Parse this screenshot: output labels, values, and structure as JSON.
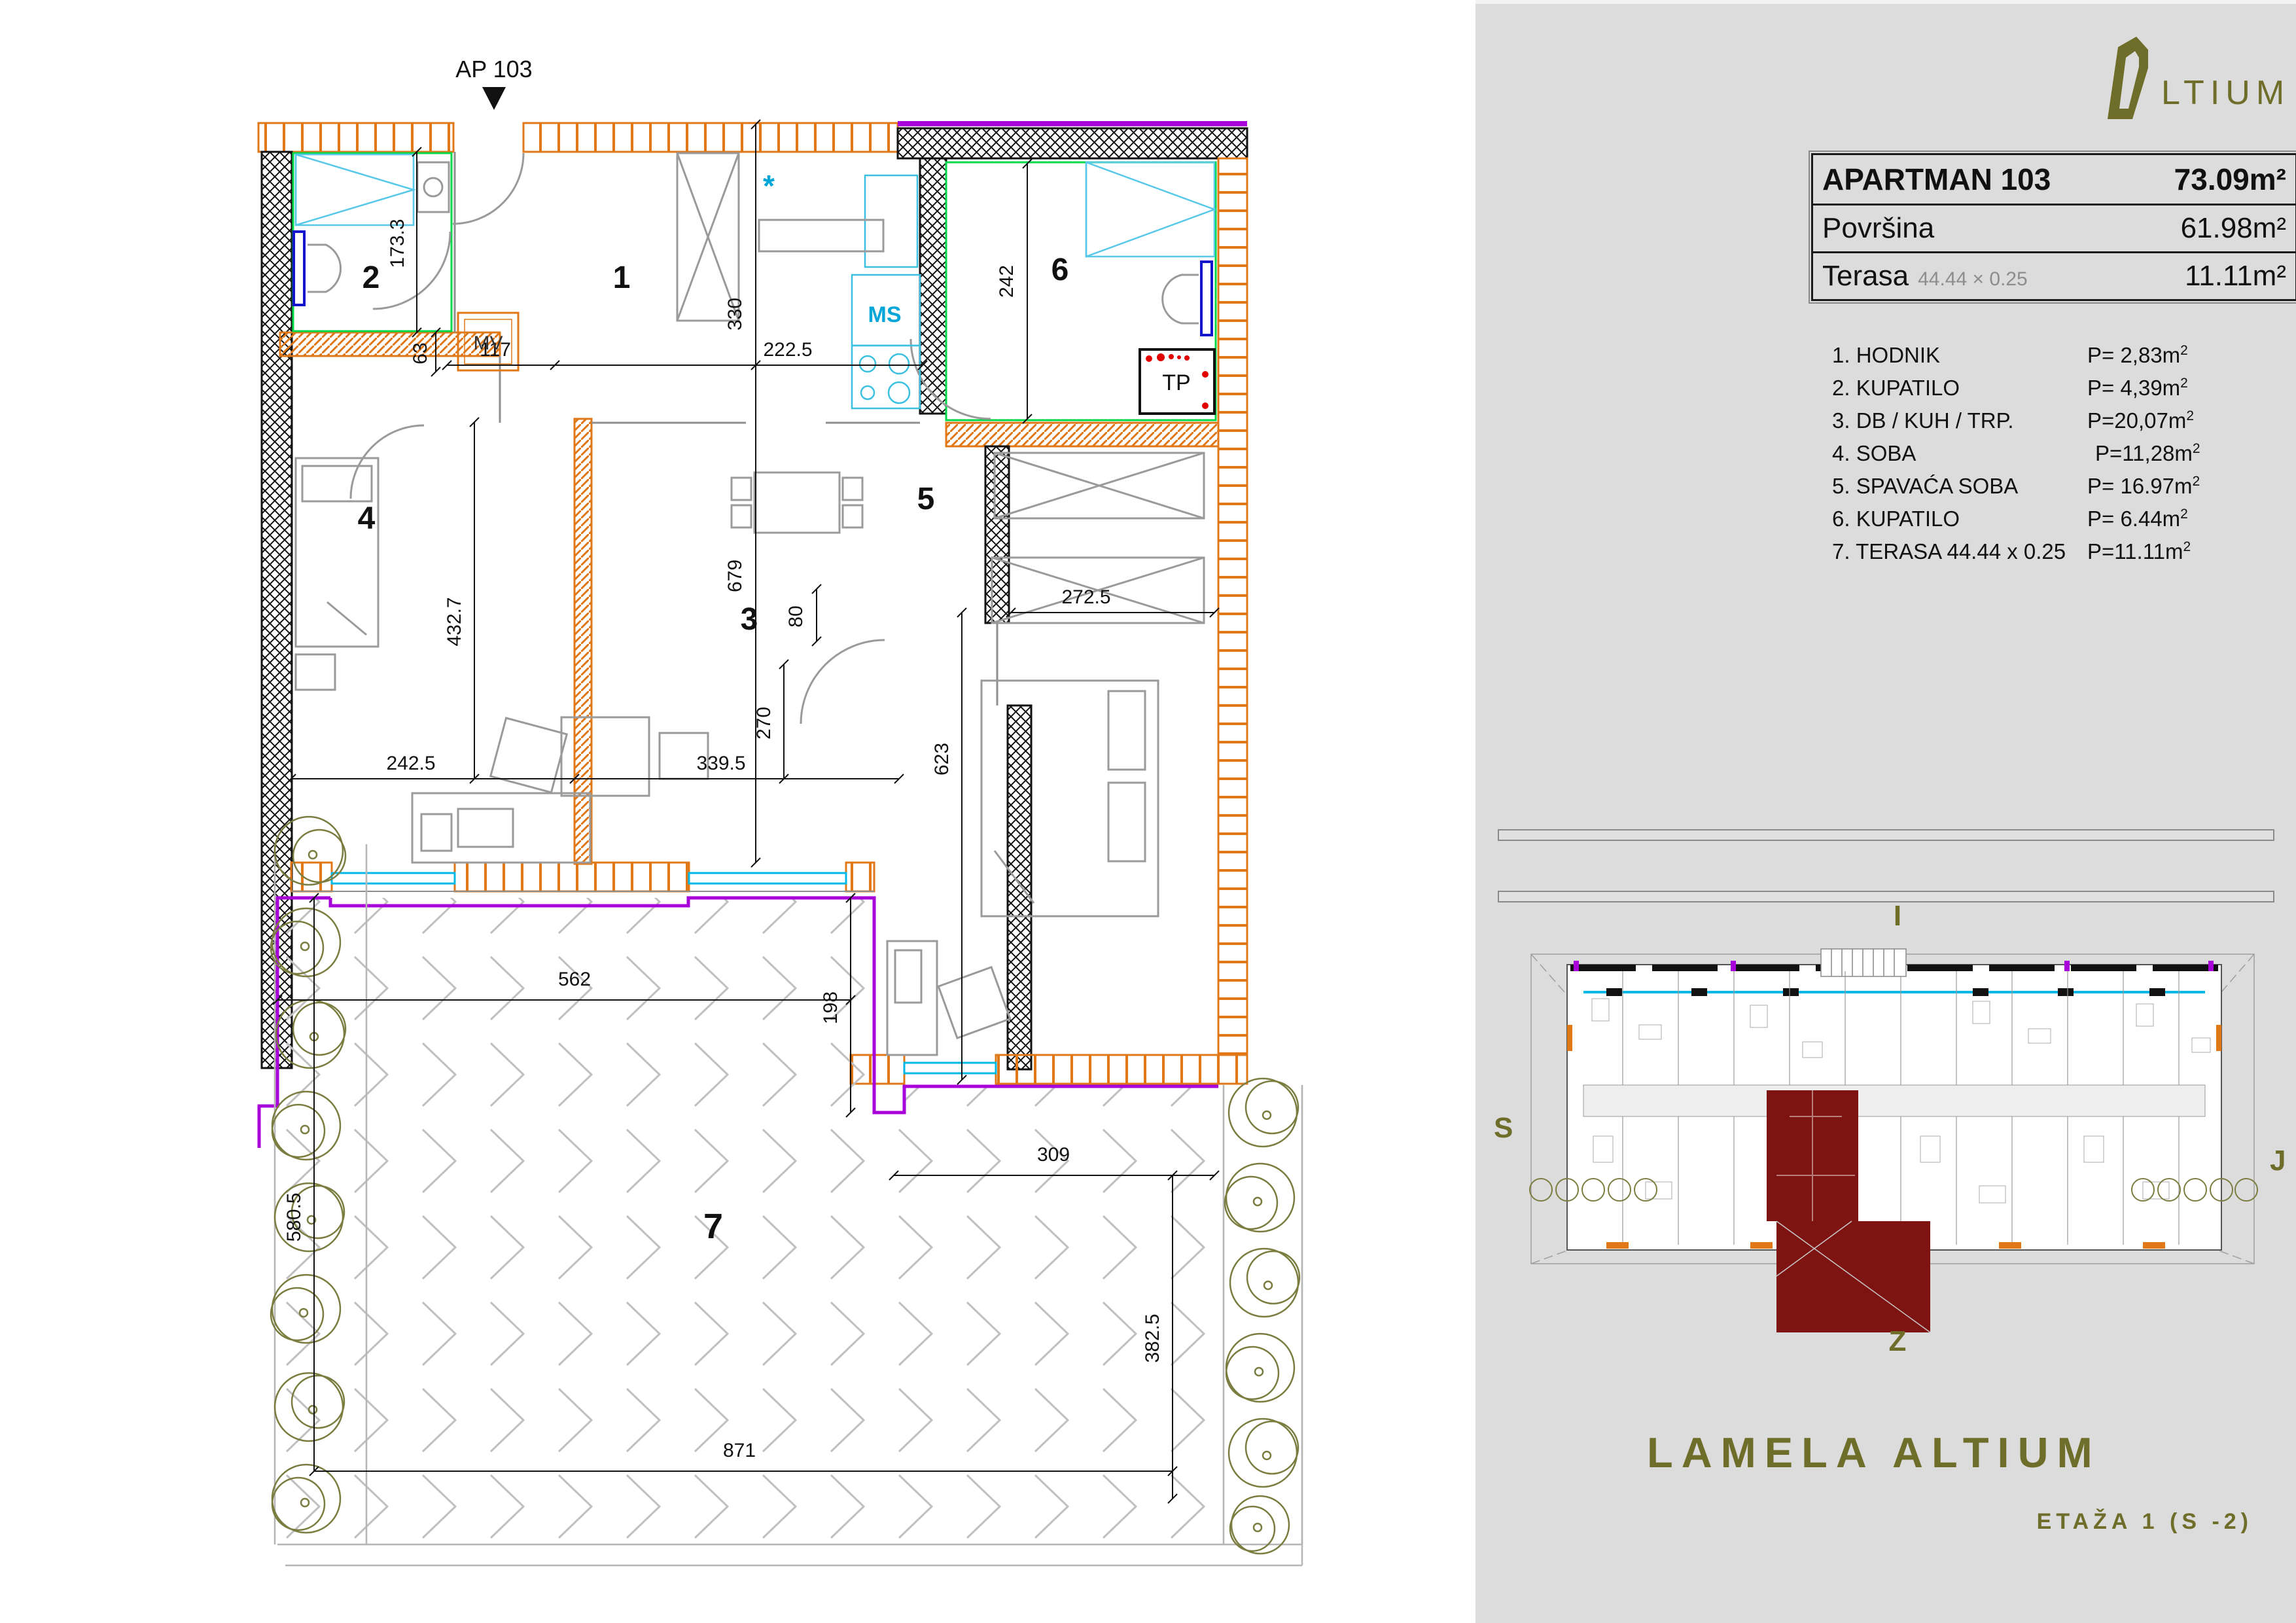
{
  "colors": {
    "orange": "#e07818",
    "purple": "#a800d8",
    "cyan": "#00b8e6",
    "green": "#00d84a",
    "blue": "#1414cc",
    "olive": "#6f6d2a",
    "red": "#e00000",
    "dark_red": "#7d1412",
    "furniture_gray": "#9a9a9a",
    "sidebar_bg": "#dcdcdc"
  },
  "plan": {
    "marker_label": "AP 103",
    "rooms": {
      "r1": "1",
      "r2": "2",
      "r3": "3",
      "r4": "4",
      "r5": "5",
      "r6": "6",
      "r7": "7"
    },
    "labels": {
      "mv": "MV",
      "ms": "MS",
      "tp": "TP",
      "star": "*"
    },
    "dims": {
      "d173": "173.3",
      "d63": "63",
      "d117": "117",
      "d330": "330",
      "d2225": "222.5",
      "d242": "242",
      "d679": "679",
      "d80": "80",
      "d4327": "432.7",
      "d2425": "242.5",
      "d3395": "339.5",
      "d270": "270",
      "d2725": "272.5",
      "d623": "623",
      "d562": "562",
      "d198": "198",
      "d5805": "580.5",
      "d309": "309",
      "d3825": "382.5",
      "d871": "871"
    }
  },
  "sidebar": {
    "logo_text": "LTIUM",
    "summary": {
      "title": "APARTMAN 103",
      "title_value": "73.09m²",
      "rows": [
        {
          "label": "Površina",
          "note": "",
          "value": "61.98m²"
        },
        {
          "label": "Terasa",
          "note": "44.44 × 0.25",
          "value": "11.11m²"
        }
      ]
    },
    "room_list": [
      {
        "name": "1. HODNIK",
        "value": "P= 2,83m",
        "sup": "2"
      },
      {
        "name": "2. KUPATILO",
        "value": "P= 4,39m",
        "sup": "2"
      },
      {
        "name": "3. DB / KUH / TRP.",
        "value": "P=20,07m",
        "sup": "2"
      },
      {
        "name": "4. SOBA",
        "value": "P=11,28m",
        "sup": "2"
      },
      {
        "name": "5. SPAVAĆA SOBA",
        "value": "P= 16.97m",
        "sup": "2"
      },
      {
        "name": "6. KUPATILO",
        "value": "P= 6.44m",
        "sup": "2"
      },
      {
        "name": "7. TERASA 44.44 x 0.25",
        "value": "P=11.11m",
        "sup": "2"
      }
    ],
    "compass": {
      "top": "I",
      "left": "S",
      "right": "J",
      "bottom": "Z"
    },
    "project_title": "LAMELA ALTIUM",
    "floor_label": "ETAŽA 1 (S -2)"
  }
}
